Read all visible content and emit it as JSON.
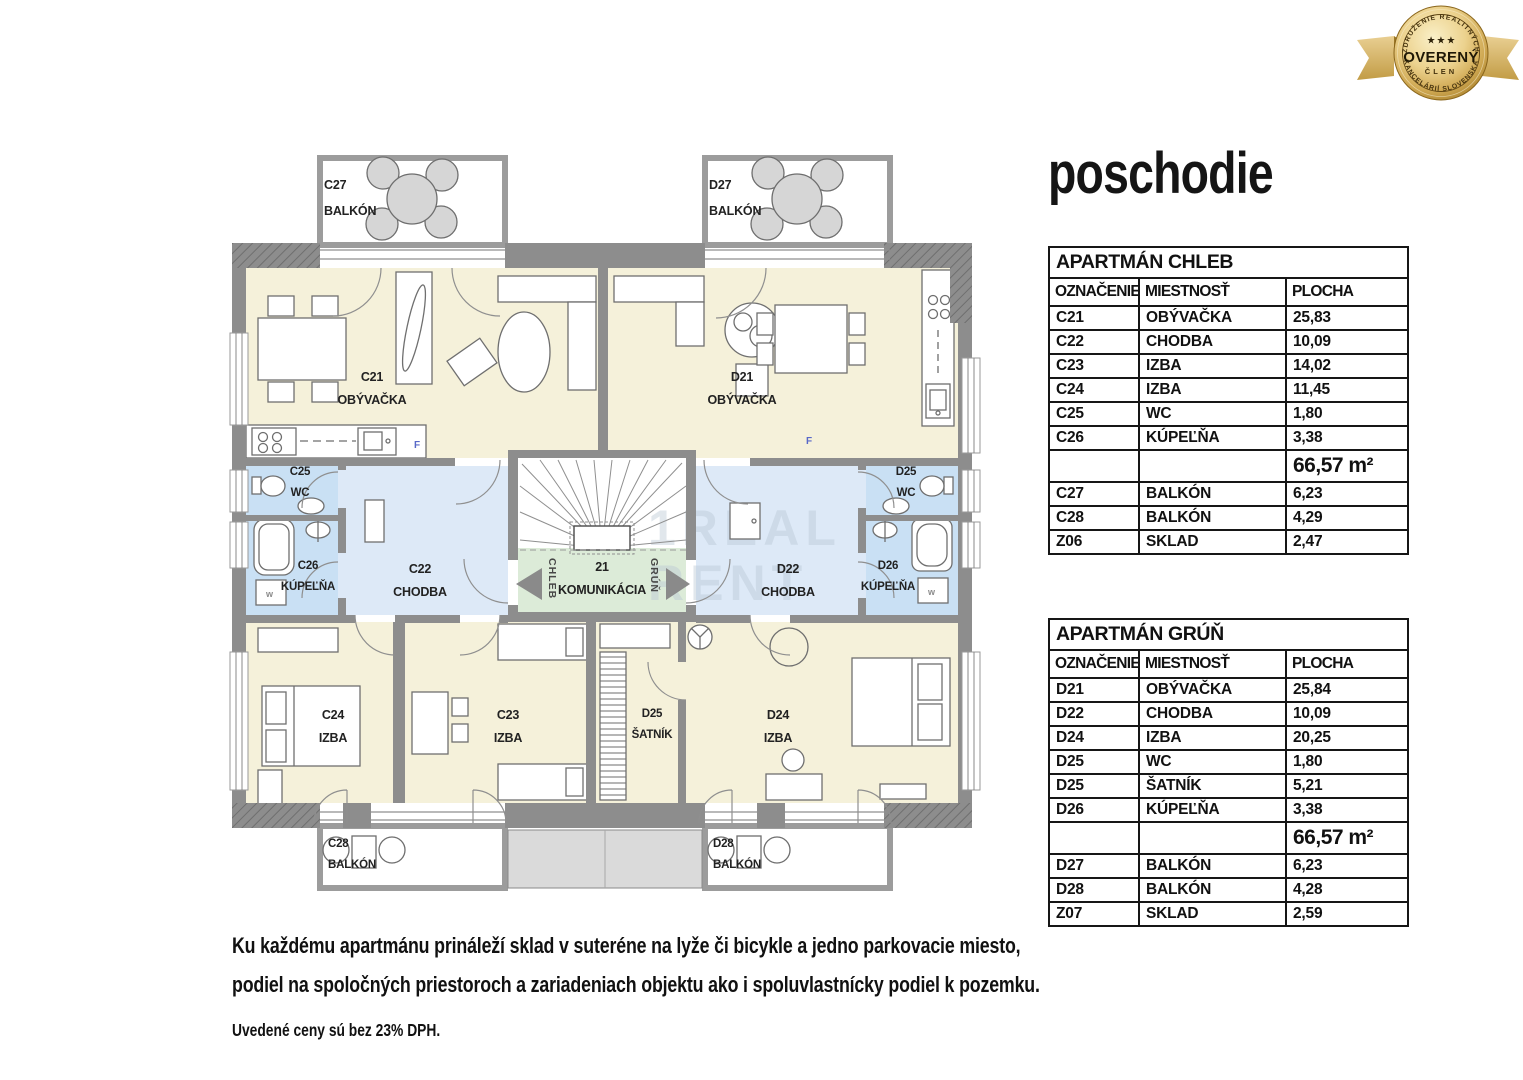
{
  "title": "poschodie",
  "badge": {
    "top_text": "ZDRUŽENIE REALITNÝCH",
    "bottom_text": "KANCELÁRIÍ SLOVENSKA",
    "stars": "★ ★ ★",
    "center": "OVERENÝ",
    "sub": "ČLEN"
  },
  "apartments": [
    {
      "title": "APARTMÁN CHLEB",
      "headers": [
        "OZNAČENIE",
        "MIESTNOSŤ",
        "PLOCHA"
      ],
      "rows": [
        [
          "C21",
          "OBÝVAČKA",
          "25,83"
        ],
        [
          "C22",
          "CHODBA",
          "10,09"
        ],
        [
          "C23",
          "IZBA",
          "14,02"
        ],
        [
          "C24",
          "IZBA",
          "11,45"
        ],
        [
          "C25",
          "WC",
          "1,80"
        ],
        [
          "C26",
          "KÚPEĽŇA",
          "3,38"
        ]
      ],
      "total": "66,57 m²",
      "extra_rows": [
        [
          "C27",
          "BALKÓN",
          "6,23"
        ],
        [
          "C28",
          "BALKÓN",
          "4,29"
        ],
        [
          "Z06",
          "SKLAD",
          "2,47"
        ]
      ]
    },
    {
      "title": "APARTMÁN GRÚŇ",
      "headers": [
        "OZNAČENIE",
        "MIESTNOSŤ",
        "PLOCHA"
      ],
      "rows": [
        [
          "D21",
          "OBÝVAČKA",
          "25,84"
        ],
        [
          "D22",
          "CHODBA",
          "10,09"
        ],
        [
          "D24",
          "IZBA",
          "20,25"
        ],
        [
          "D25",
          "WC",
          "1,80"
        ],
        [
          "D25",
          "ŠATNÍK",
          "5,21"
        ],
        [
          "D26",
          "KÚPEĽŇA",
          "3,38"
        ]
      ],
      "total": "66,57 m²",
      "extra_rows": [
        [
          "D27",
          "BALKÓN",
          "6,23"
        ],
        [
          "D28",
          "BALKÓN",
          "4,28"
        ],
        [
          "Z07",
          "SKLAD",
          "2,59"
        ]
      ]
    }
  ],
  "plan": {
    "rooms": {
      "c27": {
        "code": "C27",
        "name": "BALKÓN"
      },
      "d27": {
        "code": "D27",
        "name": "BALKÓN"
      },
      "c21": {
        "code": "C21",
        "name": "OBÝVAČKA"
      },
      "d21": {
        "code": "D21",
        "name": "OBÝVAČKA"
      },
      "c25": {
        "code": "C25",
        "name": "WC"
      },
      "c26": {
        "code": "C26",
        "name": "KÚPEĽŇA"
      },
      "c22": {
        "code": "C22",
        "name": "CHODBA"
      },
      "k21": {
        "code": "21",
        "name": "KOMUNIKÁCIA"
      },
      "d22": {
        "code": "D22",
        "name": "CHODBA"
      },
      "d25wc": {
        "code": "D25",
        "name": "WC"
      },
      "d26": {
        "code": "D26",
        "name": "KÚPEĽŇA"
      },
      "c24": {
        "code": "C24",
        "name": "IZBA"
      },
      "c23": {
        "code": "C23",
        "name": "IZBA"
      },
      "d25s": {
        "code": "D25",
        "name": "ŠATNÍK"
      },
      "d24": {
        "code": "D24",
        "name": "IZBA"
      },
      "c28": {
        "code": "C28",
        "name": "BALKÓN"
      },
      "d28": {
        "code": "D28",
        "name": "BALKÓN"
      }
    },
    "arrows": {
      "left": "CHLEB",
      "right": "GRÚŇ"
    },
    "fridge_label": "F",
    "washer_label": "w",
    "watermark": {
      "line1": "1REAL",
      "line2": "RENT"
    }
  },
  "footer": {
    "line1": "Ku každému apartmánu prináleží sklad v suteréne na lyže či bicykle a jedno parkovacie miesto,",
    "line2": "podiel na spoločných priestoroch a zariadeniach objektu ako i spoluvlastnícky podiel k pozemku.",
    "line3": "Uvedené ceny sú bez 23% DPH."
  },
  "colors": {
    "wall_gray": "#8d8d8d",
    "room_cream": "#f5f1da",
    "room_blue": "#dde9f7",
    "room_blue_deep": "#c9e0f4",
    "room_green": "#dcebd8",
    "badge_gold": "#cfa852"
  }
}
